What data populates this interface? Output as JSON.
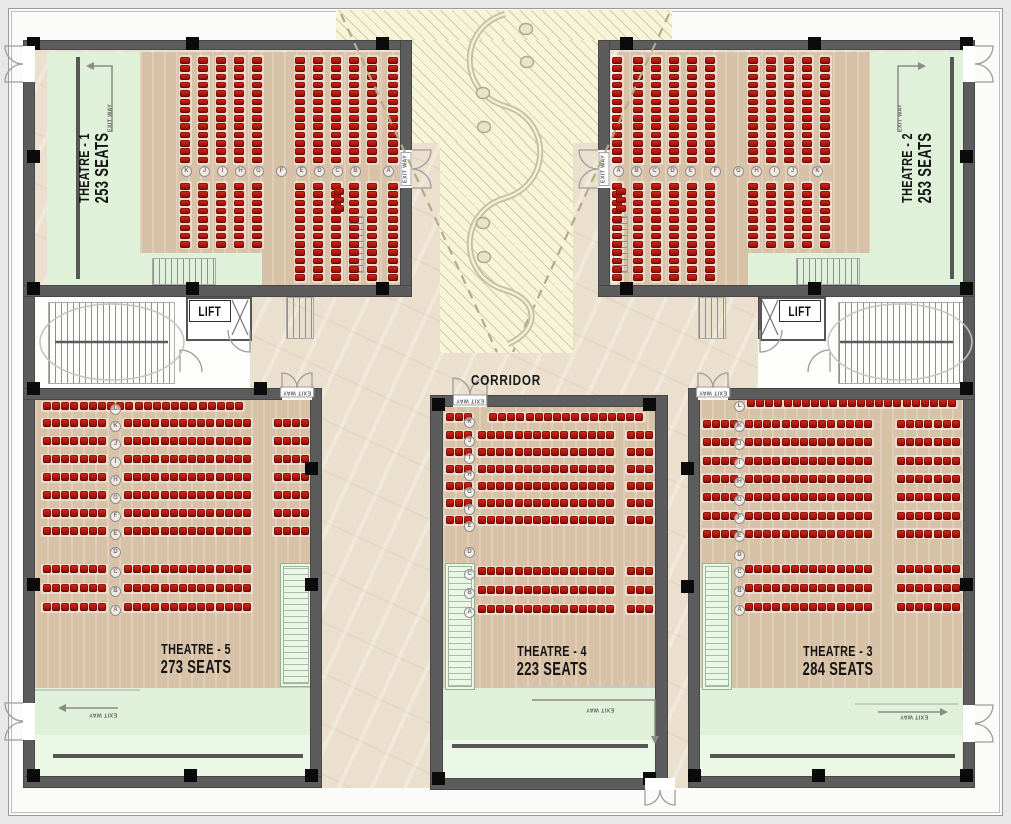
{
  "labels": {
    "corridor": "CORRIDOR",
    "lift": "LIFT",
    "exit_way": "EXIT WAY"
  },
  "theatres": {
    "t1": {
      "name": "THEATRE - 1",
      "seats": "253 SEATS",
      "row_letters": [
        "K",
        "J",
        "I",
        "H",
        "G",
        "F",
        "E",
        "D",
        "C",
        "B",
        "A"
      ]
    },
    "t2": {
      "name": "THEATRE - 2",
      "seats": "253 SEATS",
      "row_letters": [
        "A",
        "B",
        "C",
        "D",
        "E",
        "F",
        "G",
        "H",
        "I",
        "J",
        "K"
      ]
    },
    "t3": {
      "name": "THEATRE - 3",
      "seats": "284 SEATS",
      "row_letters": [
        "L",
        "K",
        "J",
        "I",
        "H",
        "G",
        "F",
        "E",
        "D",
        "C",
        "B",
        "A"
      ]
    },
    "t4": {
      "name": "THEATRE - 4",
      "seats": "223 SEATS",
      "row_letters": [
        "K",
        "J",
        "I",
        "H",
        "G",
        "F",
        "E",
        "D",
        "C",
        "B",
        "A"
      ]
    },
    "t5": {
      "name": "THEATRE - 5",
      "seats": "273 SEATS",
      "row_letters": [
        "L",
        "K",
        "J",
        "I",
        "H",
        "G",
        "F",
        "E",
        "D",
        "C",
        "B",
        "A"
      ]
    }
  },
  "colors": {
    "seat_red": "#b2170d",
    "wall_gray": "#5c5c5c",
    "wood_floor": "#d8c2a7",
    "screen_area_green": "#e0f1da",
    "corridor_marble": "#ebdfcd",
    "atrium_hatch": "#f8f4d9"
  }
}
